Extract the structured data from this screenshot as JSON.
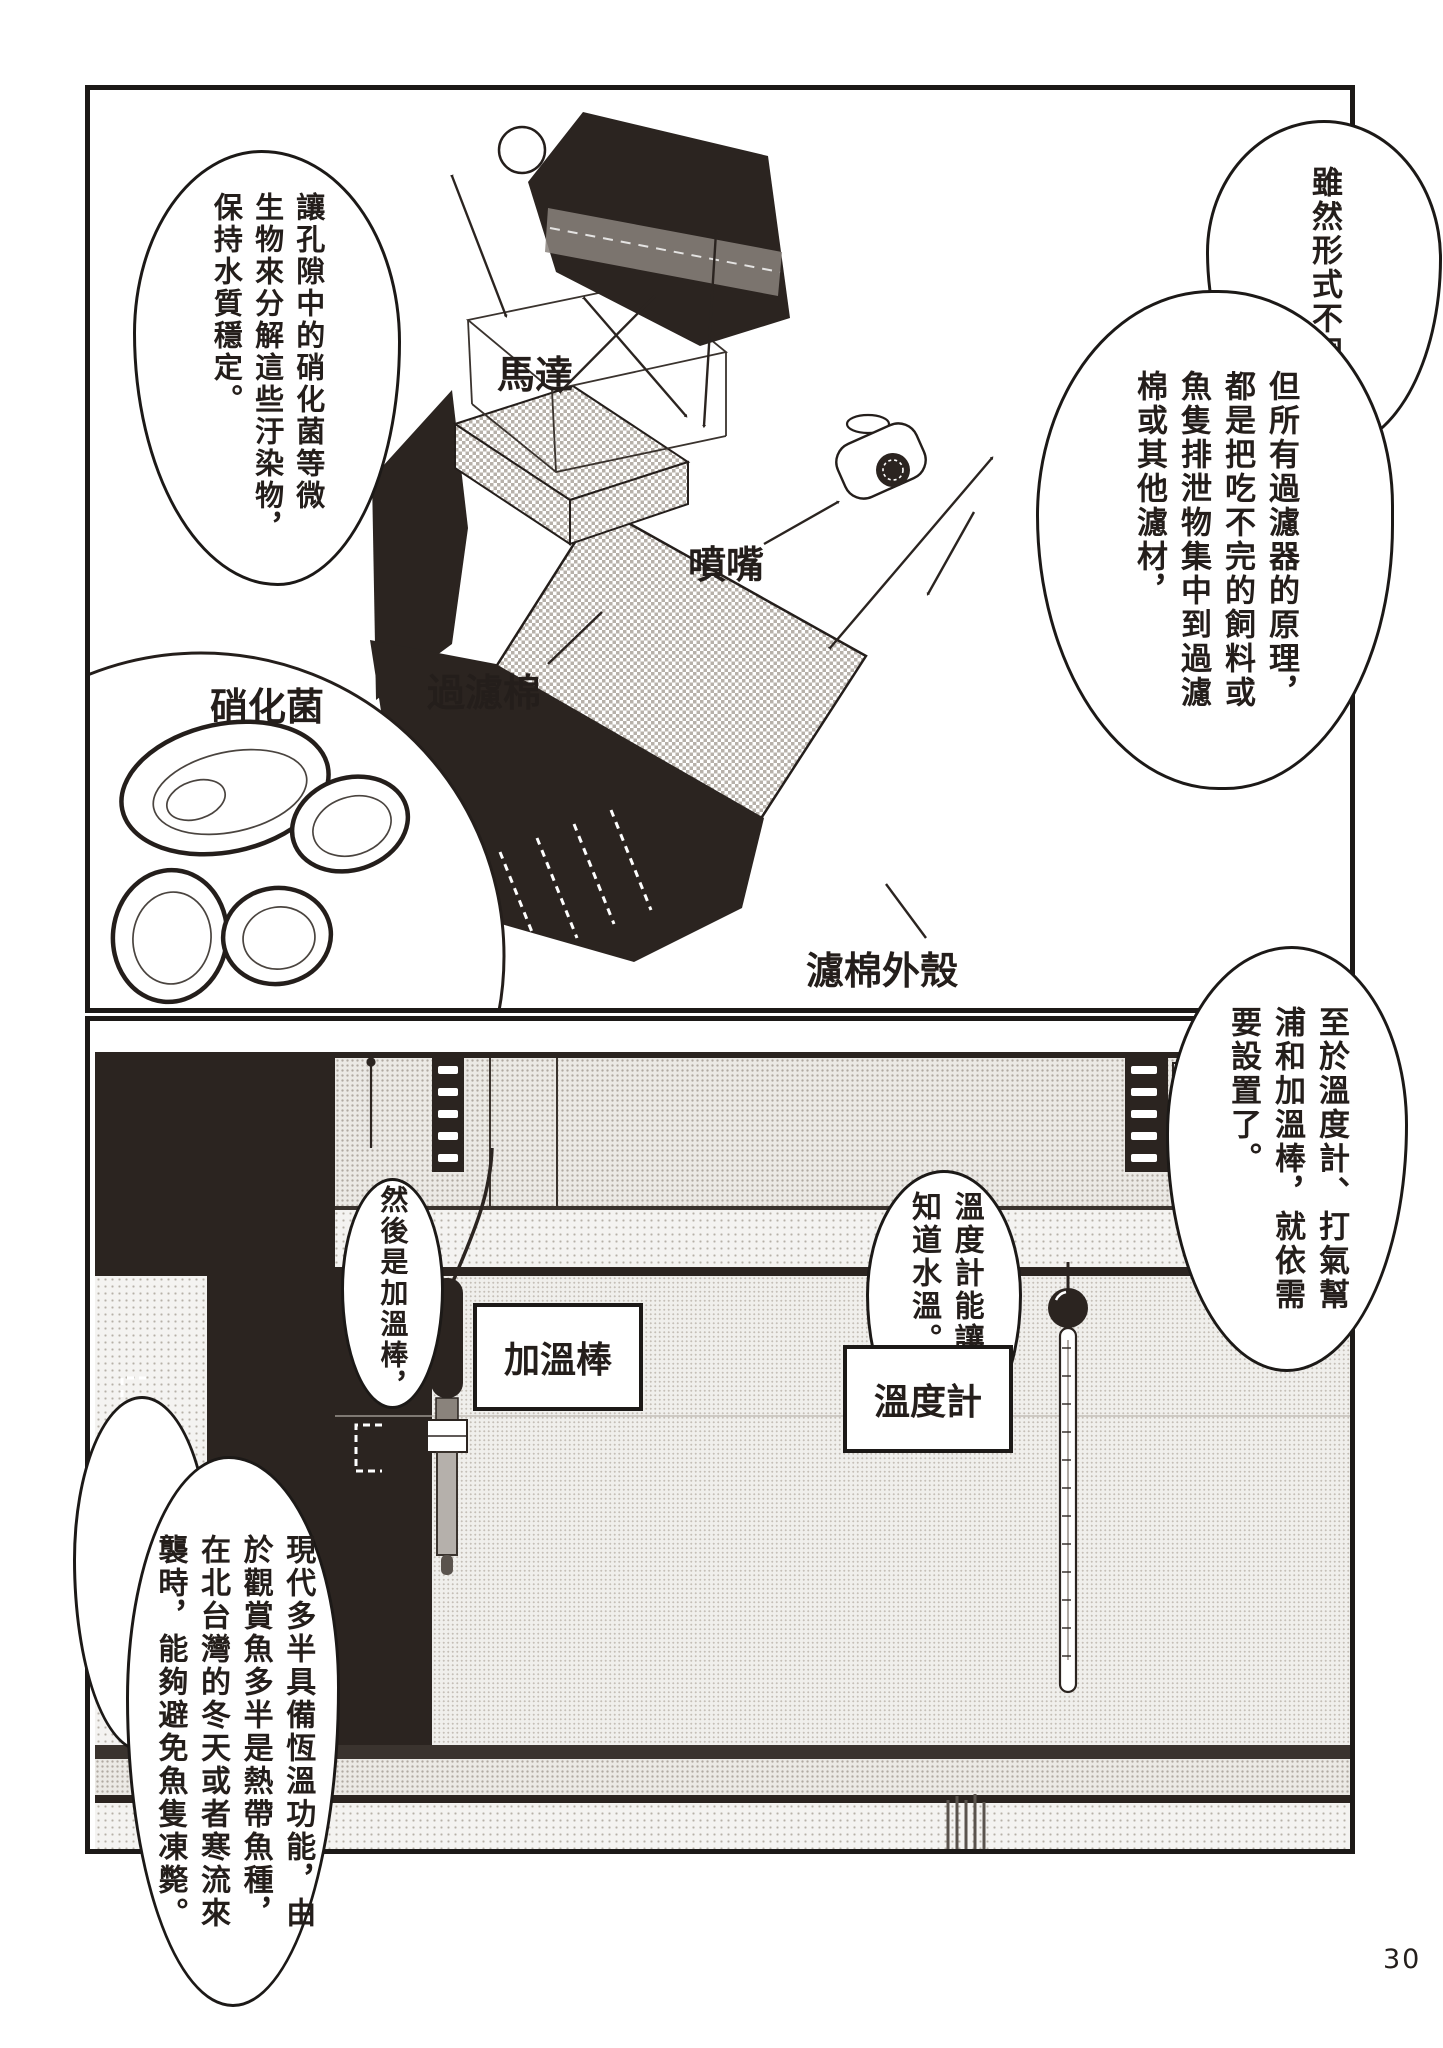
{
  "page": {
    "number": "30"
  },
  "panel1": {
    "labels": {
      "motor": "馬達",
      "filter_cotton": "過濾棉",
      "nozzle": "噴嘴",
      "casing": "濾棉外殼",
      "bacteria": "硝化菌"
    },
    "bubbles": {
      "left": "讓孔隙中的硝化菌等微\n生物來分解這些汙染物，\n保持水質穩定。",
      "top_right": "雖然形式不同，",
      "right": "但所有過濾器的原理，\n都是把吃不完的飼料或\n魚隻排泄物集中到過濾\n棉或其他濾材，"
    }
  },
  "panel2": {
    "labels": {
      "heater": "加溫棒",
      "thermometer": "溫度計"
    },
    "bubbles": {
      "top_right": "至於溫度計、打氣幫\n浦和加溫棒，就依需\n要設置了。",
      "right": "溫度計能讓我們\n知道水溫。",
      "center": "然後是加溫棒，",
      "left": "現代多半具備恆溫功能，由\n於觀賞魚多半是熱帶魚種，\n在北台灣的冬天或者寒流來\n襲時，能夠避免魚隻凍斃。"
    }
  }
}
